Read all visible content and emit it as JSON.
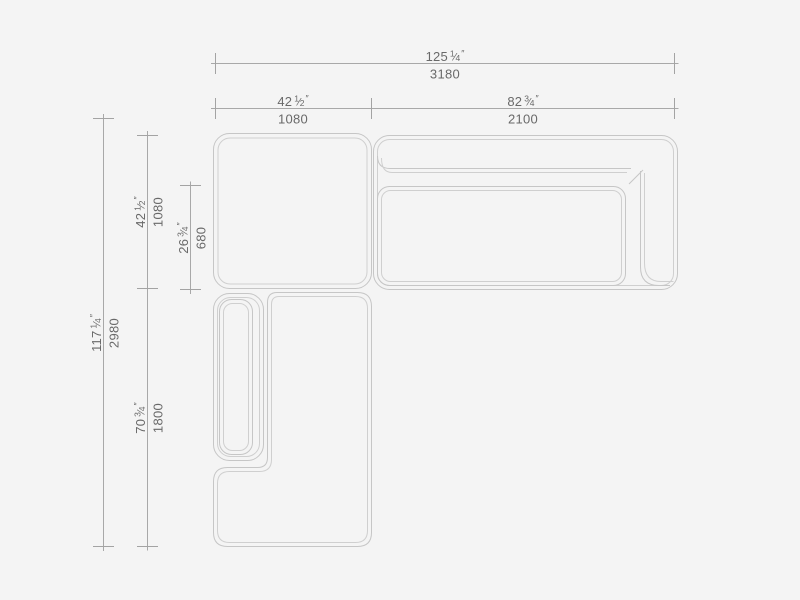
{
  "canvas": {
    "width": 800,
    "height": 600,
    "background": "#f4f4f4"
  },
  "drawing": {
    "subject": "sectional-sofa-top-view-dimension-diagram",
    "outline_color": "#c6c6c6",
    "dimension_line_color": "#a8a8a8",
    "text_color": "#696969"
  },
  "inch_mark": "″",
  "fraction_separator": "⁄",
  "dimensions": [
    {
      "id": "overall-width",
      "orientation": "horizontal",
      "inch_whole": "125",
      "inch_num": "1",
      "inch_den": "4",
      "mm": "3180"
    },
    {
      "id": "corner-width",
      "orientation": "horizontal",
      "inch_whole": "42",
      "inch_num": "1",
      "inch_den": "2",
      "mm": "1080"
    },
    {
      "id": "sofa-width",
      "orientation": "horizontal",
      "inch_whole": "82",
      "inch_num": "3",
      "inch_den": "4",
      "mm": "2100"
    },
    {
      "id": "overall-depth",
      "orientation": "vertical",
      "inch_whole": "117",
      "inch_num": "1",
      "inch_den": "4",
      "mm": "2980"
    },
    {
      "id": "corner-depth",
      "orientation": "vertical",
      "inch_whole": "42",
      "inch_num": "1",
      "inch_den": "2",
      "mm": "1080"
    },
    {
      "id": "seat-depth",
      "orientation": "vertical",
      "inch_whole": "26",
      "inch_num": "3",
      "inch_den": "4",
      "mm": "680"
    },
    {
      "id": "chaise-depth",
      "orientation": "vertical",
      "inch_whole": "70",
      "inch_num": "3",
      "inch_den": "4",
      "mm": "1800"
    }
  ]
}
